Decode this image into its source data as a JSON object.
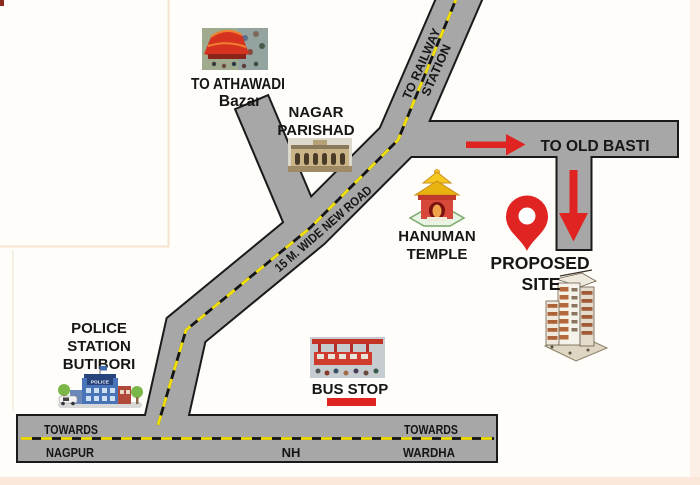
{
  "colors": {
    "accent_red": "#e02421",
    "road_gray": "#a7a7a7",
    "road_border": "#1a1a1a",
    "dash_yellow": "#f2e005",
    "page_edge_pink": "#fbe8db",
    "fold_line": "#f6e2cf"
  },
  "map": {
    "landmarks": {
      "athawadi": {
        "line1": "TO ATHAWADI",
        "line2": "Bazar"
      },
      "nagar_parishad": {
        "line1": "NAGAR",
        "line2": "PARISHAD"
      },
      "hanuman_temple": {
        "line1": "HANUMAN",
        "line2": "TEMPLE"
      },
      "police_station": {
        "line1": "POLICE",
        "line2": "STATION",
        "line3": "BUTIBORI",
        "sign": "POLICE"
      },
      "bus_stop": {
        "label": "BUS STOP"
      },
      "proposed_site": {
        "line1": "PROPOSED",
        "line2": "SITE"
      }
    },
    "roads": {
      "railway": {
        "line1": "TO RAILWAY",
        "line2": "STATION"
      },
      "old_basti": {
        "label": "TO OLD BASTI"
      },
      "new_road": {
        "label": "15 M. WIDE NEW ROAD"
      },
      "highway": {
        "left_line1": "TOWARDS",
        "left_line2": "NAGPUR",
        "center": "NH",
        "right_line1": "TOWARDS",
        "right_line2": "WARDHA"
      }
    }
  }
}
